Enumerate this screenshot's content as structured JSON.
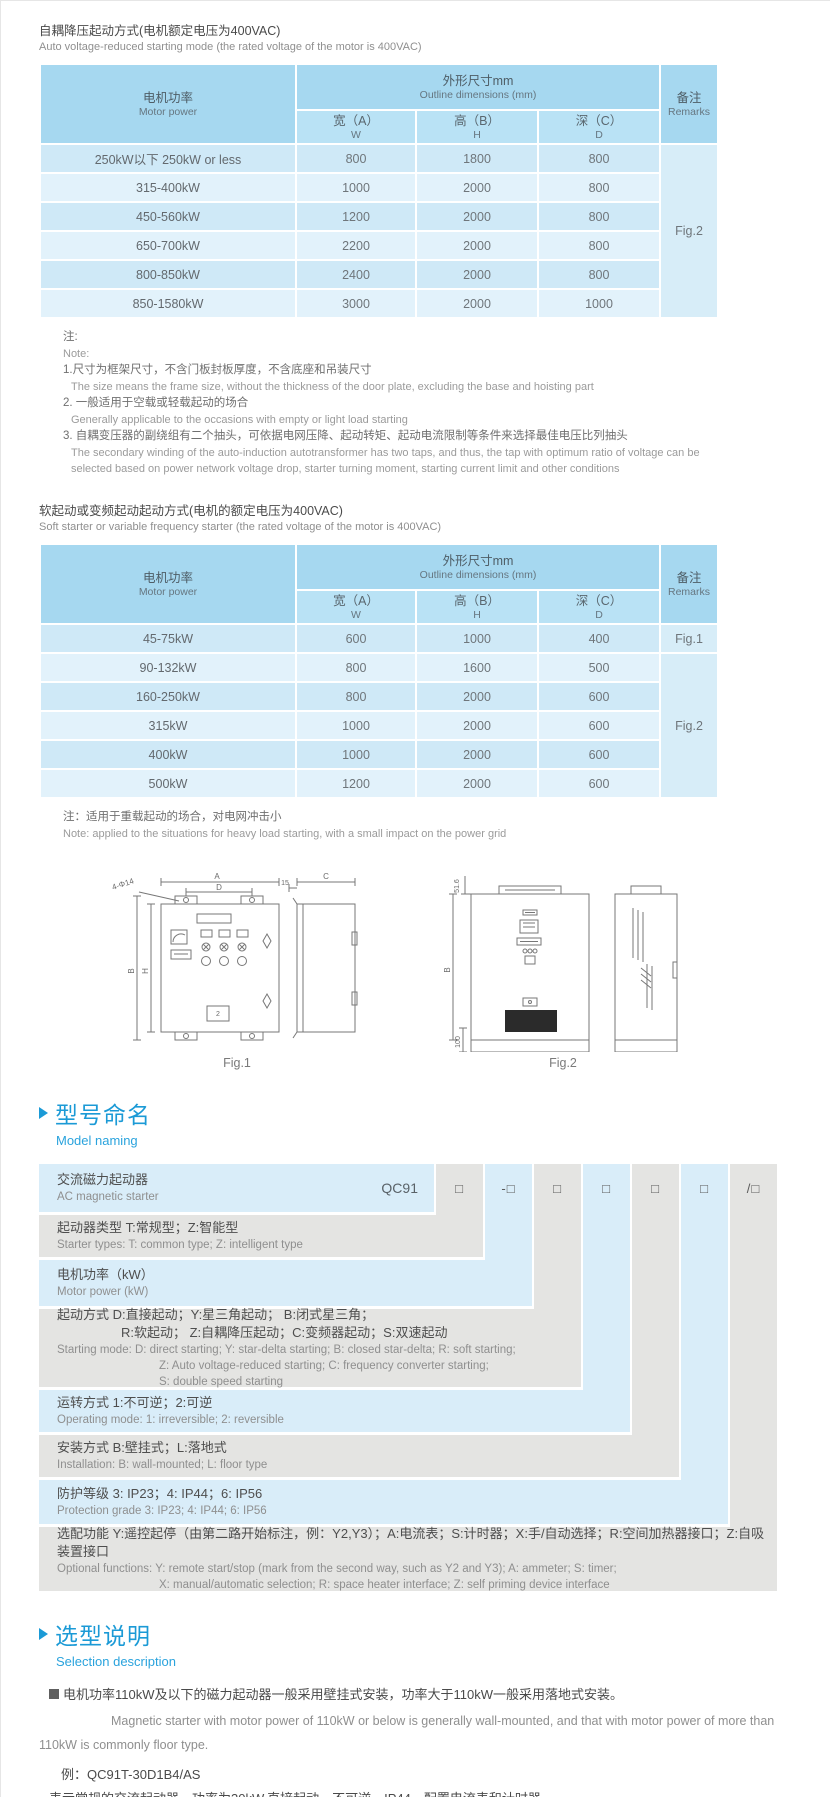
{
  "colors": {
    "accent_blue": "#1b9ad6",
    "table_header_blue": "#a6d8f0",
    "table_subheader_blue": "#b9e2f5",
    "row_blue_dark": "#cfe9f7",
    "row_blue_light": "#e2f2fb",
    "naming_gray": "#e4e4e2",
    "naming_blue": "#d9edf9"
  },
  "table1": {
    "title_zh": "自耦降压起动方式(电机额定电压为400VAC)",
    "title_en": "Auto voltage-reduced starting mode (the rated voltage of the motor is 400VAC)",
    "header": {
      "motor_zh": "电机功率",
      "motor_en": "Motor power",
      "dims_zh": "外形尺寸mm",
      "dims_en": "Outline dimensions (mm)",
      "w_zh": "宽（A）",
      "w_en": "W",
      "h_zh": "高（B）",
      "h_en": "H",
      "d_zh": "深（C）",
      "d_en": "D",
      "remarks_zh": "备注",
      "remarks_en": "Remarks"
    },
    "rows": [
      {
        "power": "250kW以下 250kW or less",
        "w": "800",
        "h": "1800",
        "d": "800"
      },
      {
        "power": "315-400kW",
        "w": "1000",
        "h": "2000",
        "d": "800"
      },
      {
        "power": "450-560kW",
        "w": "1200",
        "h": "2000",
        "d": "800"
      },
      {
        "power": "650-700kW",
        "w": "2200",
        "h": "2000",
        "d": "800"
      },
      {
        "power": "800-850kW",
        "w": "2400",
        "h": "2000",
        "d": "800"
      },
      {
        "power": "850-1580kW",
        "w": "3000",
        "h": "2000",
        "d": "1000"
      }
    ],
    "remark_groups": [
      {
        "label": "Fig.2",
        "span": 6
      }
    ]
  },
  "notes1": {
    "zh": "注:",
    "en": "Note:",
    "items": [
      {
        "zh": "1.尺寸为框架尺寸，不含门板封板厚度，不含底座和吊装尺寸",
        "en": "The size means the frame size, without the thickness of the door plate, excluding the base and hoisting part"
      },
      {
        "zh": "2. 一般适用于空载或轻载起动的场合",
        "en": "Generally applicable to the occasions with empty or light load starting"
      },
      {
        "zh": "3. 自耦变压器的副绕组有二个抽头，可依据电网压降、起动转矩、起动电流限制等条件来选择最佳电压比列抽头",
        "en": "The secondary winding of the auto-induction autotransformer has two taps, and thus, the tap with optimum ratio of voltage can be selected based on power network voltage drop, starter turning moment, starting current limit and other conditions"
      }
    ]
  },
  "table2": {
    "title_zh": "软起动或变频起动起动方式(电机的额定电压为400VAC)",
    "title_en": "Soft starter or variable frequency starter (the rated voltage of the motor is 400VAC)",
    "rows": [
      {
        "power": "45-75kW",
        "w": "600",
        "h": "1000",
        "d": "400"
      },
      {
        "power": "90-132kW",
        "w": "800",
        "h": "1600",
        "d": "500"
      },
      {
        "power": "160-250kW",
        "w": "800",
        "h": "2000",
        "d": "600"
      },
      {
        "power": "315kW",
        "w": "1000",
        "h": "2000",
        "d": "600"
      },
      {
        "power": "400kW",
        "w": "1000",
        "h": "2000",
        "d": "600"
      },
      {
        "power": "500kW",
        "w": "1200",
        "h": "2000",
        "d": "600"
      }
    ],
    "remark_groups": [
      {
        "label": "Fig.1",
        "span": 1
      },
      {
        "label": "Fig.2",
        "span": 5
      }
    ]
  },
  "note2": {
    "zh": "注：适用于重载起动的场合，对电网冲击小",
    "en": "Note: applied to the situations for heavy load starting, with a small impact on the power grid"
  },
  "figures": {
    "fig1": {
      "caption": "Fig.1",
      "dim_a": "A",
      "dim_d": "D",
      "dim_b": "B",
      "dim_h": "H",
      "holes": "4-Φ14",
      "dim_15": "15",
      "dim_c": "C",
      "panel_num": "2"
    },
    "fig2": {
      "caption": "Fig.2",
      "dim_516": "51.6",
      "dim_b": "B",
      "dim_100": "100",
      "dim_a": "A",
      "dim_c": "C"
    }
  },
  "model_naming": {
    "heading_zh": "型号命名",
    "heading_en": "Model naming",
    "code": "QC91",
    "boxes": [
      "□",
      "-□",
      "□",
      "□",
      "□",
      "□",
      "/□"
    ],
    "rows": [
      {
        "zh_lines": [
          "交流磁力起动器"
        ],
        "en_lines": [
          "AC magnetic starter"
        ]
      },
      {
        "zh_lines": [
          "起动器类型 T:常规型；Z:智能型"
        ],
        "en_lines": [
          "Starter types: T: common type; Z: intelligent type"
        ]
      },
      {
        "zh_lines": [
          "电机功率（kW）"
        ],
        "en_lines": [
          "Motor power (kW)"
        ]
      },
      {
        "zh_lines": [
          "起动方式 D:直接起动；Y:星三角起动；  B:闭式星三角；",
          "R:软起动；  Z:自耦降压起动；C:变频器起动；S:双速起动"
        ],
        "en_lines": [
          "Starting mode: D: direct starting; Y: star-delta starting; B: closed star-delta; R: soft starting;",
          "Z: Auto voltage-reduced starting; C: frequency converter starting;",
          "S: double speed starting"
        ]
      },
      {
        "zh_lines": [
          "运转方式 1:不可逆；2:可逆"
        ],
        "en_lines": [
          "Operating mode: 1: irreversible; 2: reversible"
        ]
      },
      {
        "zh_lines": [
          "安装方式 B:壁挂式；L:落地式"
        ],
        "en_lines": [
          "Installation: B: wall-mounted; L: floor type"
        ]
      },
      {
        "zh_lines": [
          "防护等级 3: IP23；4: IP44；6: IP56"
        ],
        "en_lines": [
          "Protection grade 3: IP23; 4: IP44; 6: IP56"
        ]
      },
      {
        "zh_lines": [
          "选配功能 Y:遥控起停（由第二路开始标注，例：Y2,Y3）；A:电流表；S:计时器；X:手/自动选择；R:空间加热器接口；Z:自吸装置接口"
        ],
        "en_lines": [
          "Optional functions: Y: remote start/stop (mark from the second way, such as Y2 and Y3); A: ammeter; S: timer;",
          "X: manual/automatic selection; R: space heater interface; Z: self priming device interface"
        ]
      }
    ]
  },
  "selection": {
    "heading_zh": "选型说明",
    "heading_en": "Selection description",
    "bullet_zh": "电机功率110kW及以下的磁力起动器一般采用壁挂式安装，功率大于110kW一般采用落地式安装。",
    "para_en": "Magnetic starter with motor power of 110kW or below is generally wall-mounted, and that with motor power of more than 110kW is commonly floor type.",
    "example": "例：QC91T-30D1B4/AS",
    "example_zh": "表示常规的交流起动器，功率为30kW,直接起动，不可逆，IP44，配置电流表和计时器",
    "example_en": "It means: AC magnetic starter, power is 30kW, DOL starting mode, irreversible, IP44, with ammeter and timer."
  }
}
